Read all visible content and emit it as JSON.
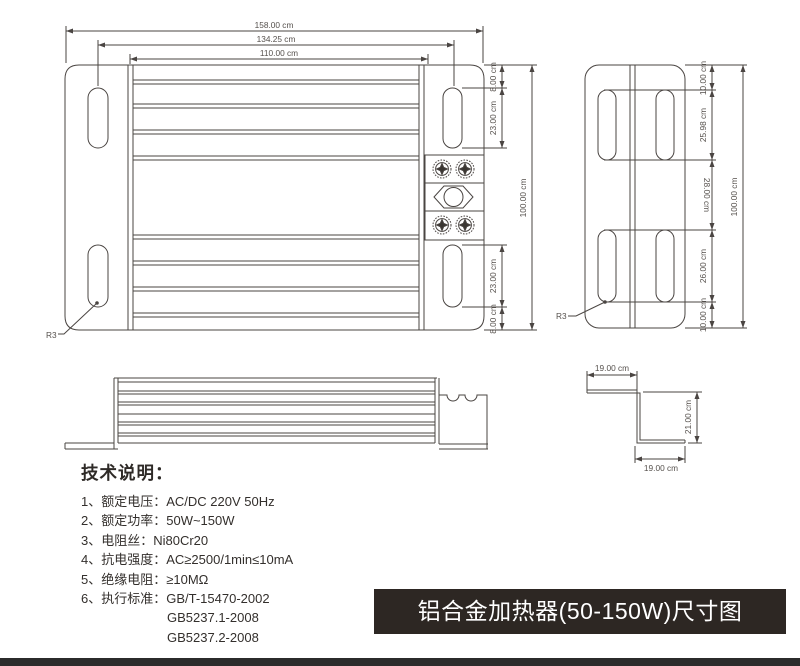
{
  "banner": {
    "text": "铝合金加热器(50-150W)尺寸图",
    "bg": "#2d2723",
    "fg": "#ffffff"
  },
  "specs": {
    "heading": "技术说明：",
    "items": [
      "1、额定电压：AC/DC 220V 50Hz",
      "2、额定功率：50W~150W",
      "3、电阻丝：Ni80Cr20",
      "4、抗电强度：AC≥2500/1min≤10mA",
      "5、绝缘电阻：≥10MΩ",
      "6、执行标准：GB/T-15470-2002"
    ],
    "continuations": [
      "GB5237.1-2008",
      "GB5237.2-2008"
    ]
  },
  "front_view": {
    "width_total": "158.00 cm",
    "width_slot_centers": "134.25 cm",
    "width_body": "110.00 cm",
    "top_offset": "8.00 cm",
    "slot_top_height": "23.00 cm",
    "slot_bottom_height": "23.00 cm",
    "bottom_offset": "8.00 cm",
    "height_total": "100.00 cm",
    "corner_radius": "R3"
  },
  "side_view": {
    "top_offset": "10.00 cm",
    "slot_top_height": "25.98 cm",
    "middle_gap": "28.00 cm",
    "slot_bottom_height": "26.00 cm",
    "bottom_offset": "10.00 cm",
    "height_total": "100.00 cm",
    "corner_radius": "R3"
  },
  "bracket_detail": {
    "top_width": "19.00 cm",
    "height": "21.00 cm",
    "bottom_width": "19.00 cm"
  },
  "colors": {
    "line": "#4a4542",
    "dim_text": "#55504c",
    "spec_text": "#332f2c",
    "banner_bg": "#2d2723"
  }
}
